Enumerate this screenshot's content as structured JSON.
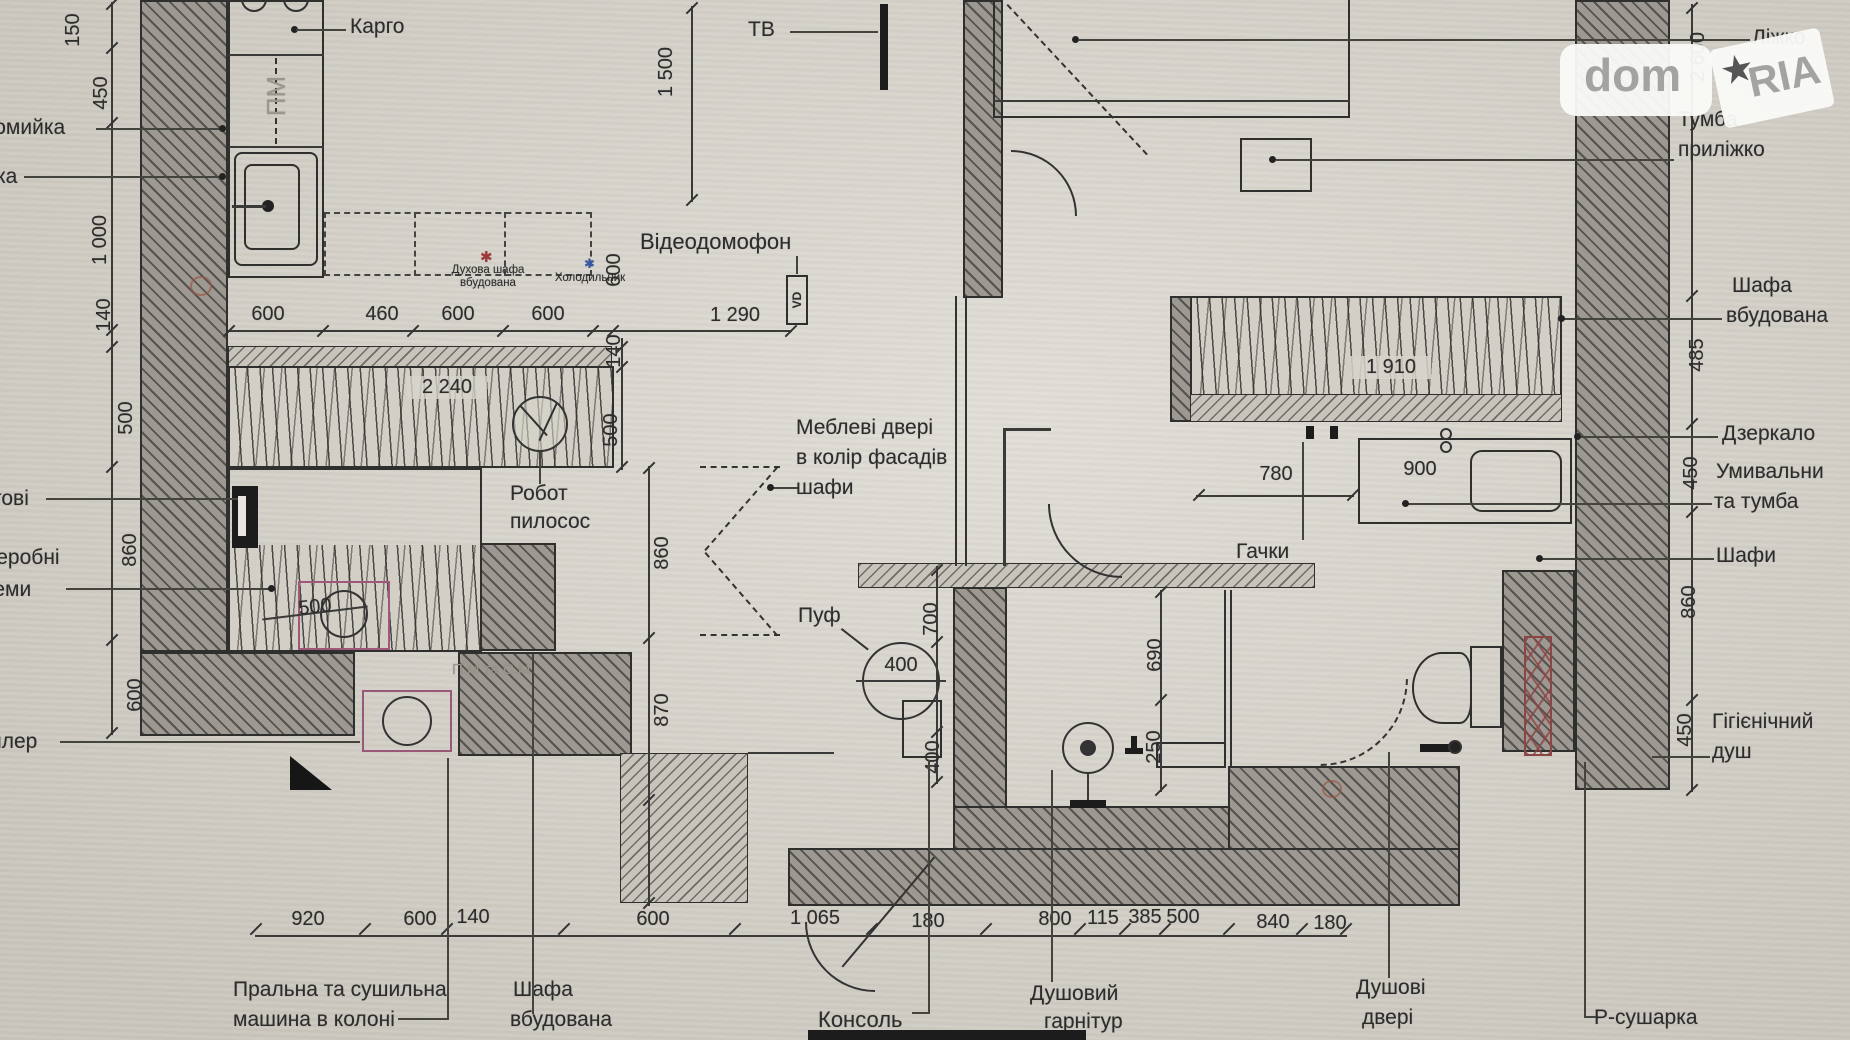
{
  "colors": {
    "paper": "#d7d3ca",
    "line": "#2f2f2d",
    "red_star": "#a03838",
    "blue_star": "#3858a8",
    "fixture_magenta": "#a05878",
    "dryer_red": "#8a4545",
    "watermark_gray": "#a3a3a1"
  },
  "watermark": {
    "dom": "dom",
    "ria": "RIA",
    "star": "★"
  },
  "labels": {
    "kargo": "Карго",
    "pm": "ПМ",
    "tv": "ТВ",
    "videophone": "Відеодомофон",
    "vd": "VD",
    "oven1": "Духова шафа",
    "oven2": "вбудована",
    "star": "✱",
    "fridge": "Холодильник",
    "robot1": "Робот",
    "robot2": "пилосос",
    "doors1": "Меблеві двері",
    "doors2": "в колір фасадів",
    "doors3": "шафи",
    "pouf": "Пуф",
    "hooks": "Гачки",
    "bed": "Ліжко",
    "tumba1": "Тумба",
    "tumba2": "приліжко",
    "shafa_r1": "Шафа",
    "shafa_r2": "вбудована",
    "mirror": "Дзеркало",
    "sink1": "Умивальни",
    "sink2": "та тумба",
    "shafy": "Шафи",
    "hyg1": "Гігієнічний",
    "hyg2": "душ",
    "washer1": "Пральна та сушильна",
    "washer2": "машина в колоні",
    "shafa_b1": "Шафа",
    "shafa_b2": "вбудована",
    "console": "Консоль",
    "shw1": "Душовий",
    "shw2": "гарнітур",
    "shd1": "Душові",
    "shd2": "двері",
    "dryer": "Р-сушарка",
    "pmsm": "П.М та С.М.",
    "cut1": "домийка",
    "cut2": "ка",
    "cut3": "тові",
    "cut4": "деробні",
    "cut5": "теми",
    "cut6": "йлер"
  },
  "dims": {
    "left": [
      "150",
      "450",
      "1 000",
      "140",
      "500",
      "860",
      "600"
    ],
    "kitchen": [
      "600",
      "460",
      "600",
      "600"
    ],
    "bottom": [
      "920",
      "600",
      "140",
      "600",
      "1 065",
      "180",
      "800",
      "115",
      "385",
      "500",
      "840",
      "180"
    ],
    "right": [
      "485",
      "450",
      "860",
      "450"
    ],
    "v600": "600",
    "v140": "140",
    "v500": "500",
    "v860": "860",
    "v870": "870",
    "d2240": "2 240",
    "d1290": "1 290",
    "d1500": "1 500",
    "d1910": "1 910",
    "d2600": "2 600",
    "d780": "780",
    "d900": "900",
    "v690": "690",
    "v250": "250",
    "v700": "700",
    "v400": "400",
    "pouf_d": "400",
    "closet": "500"
  }
}
